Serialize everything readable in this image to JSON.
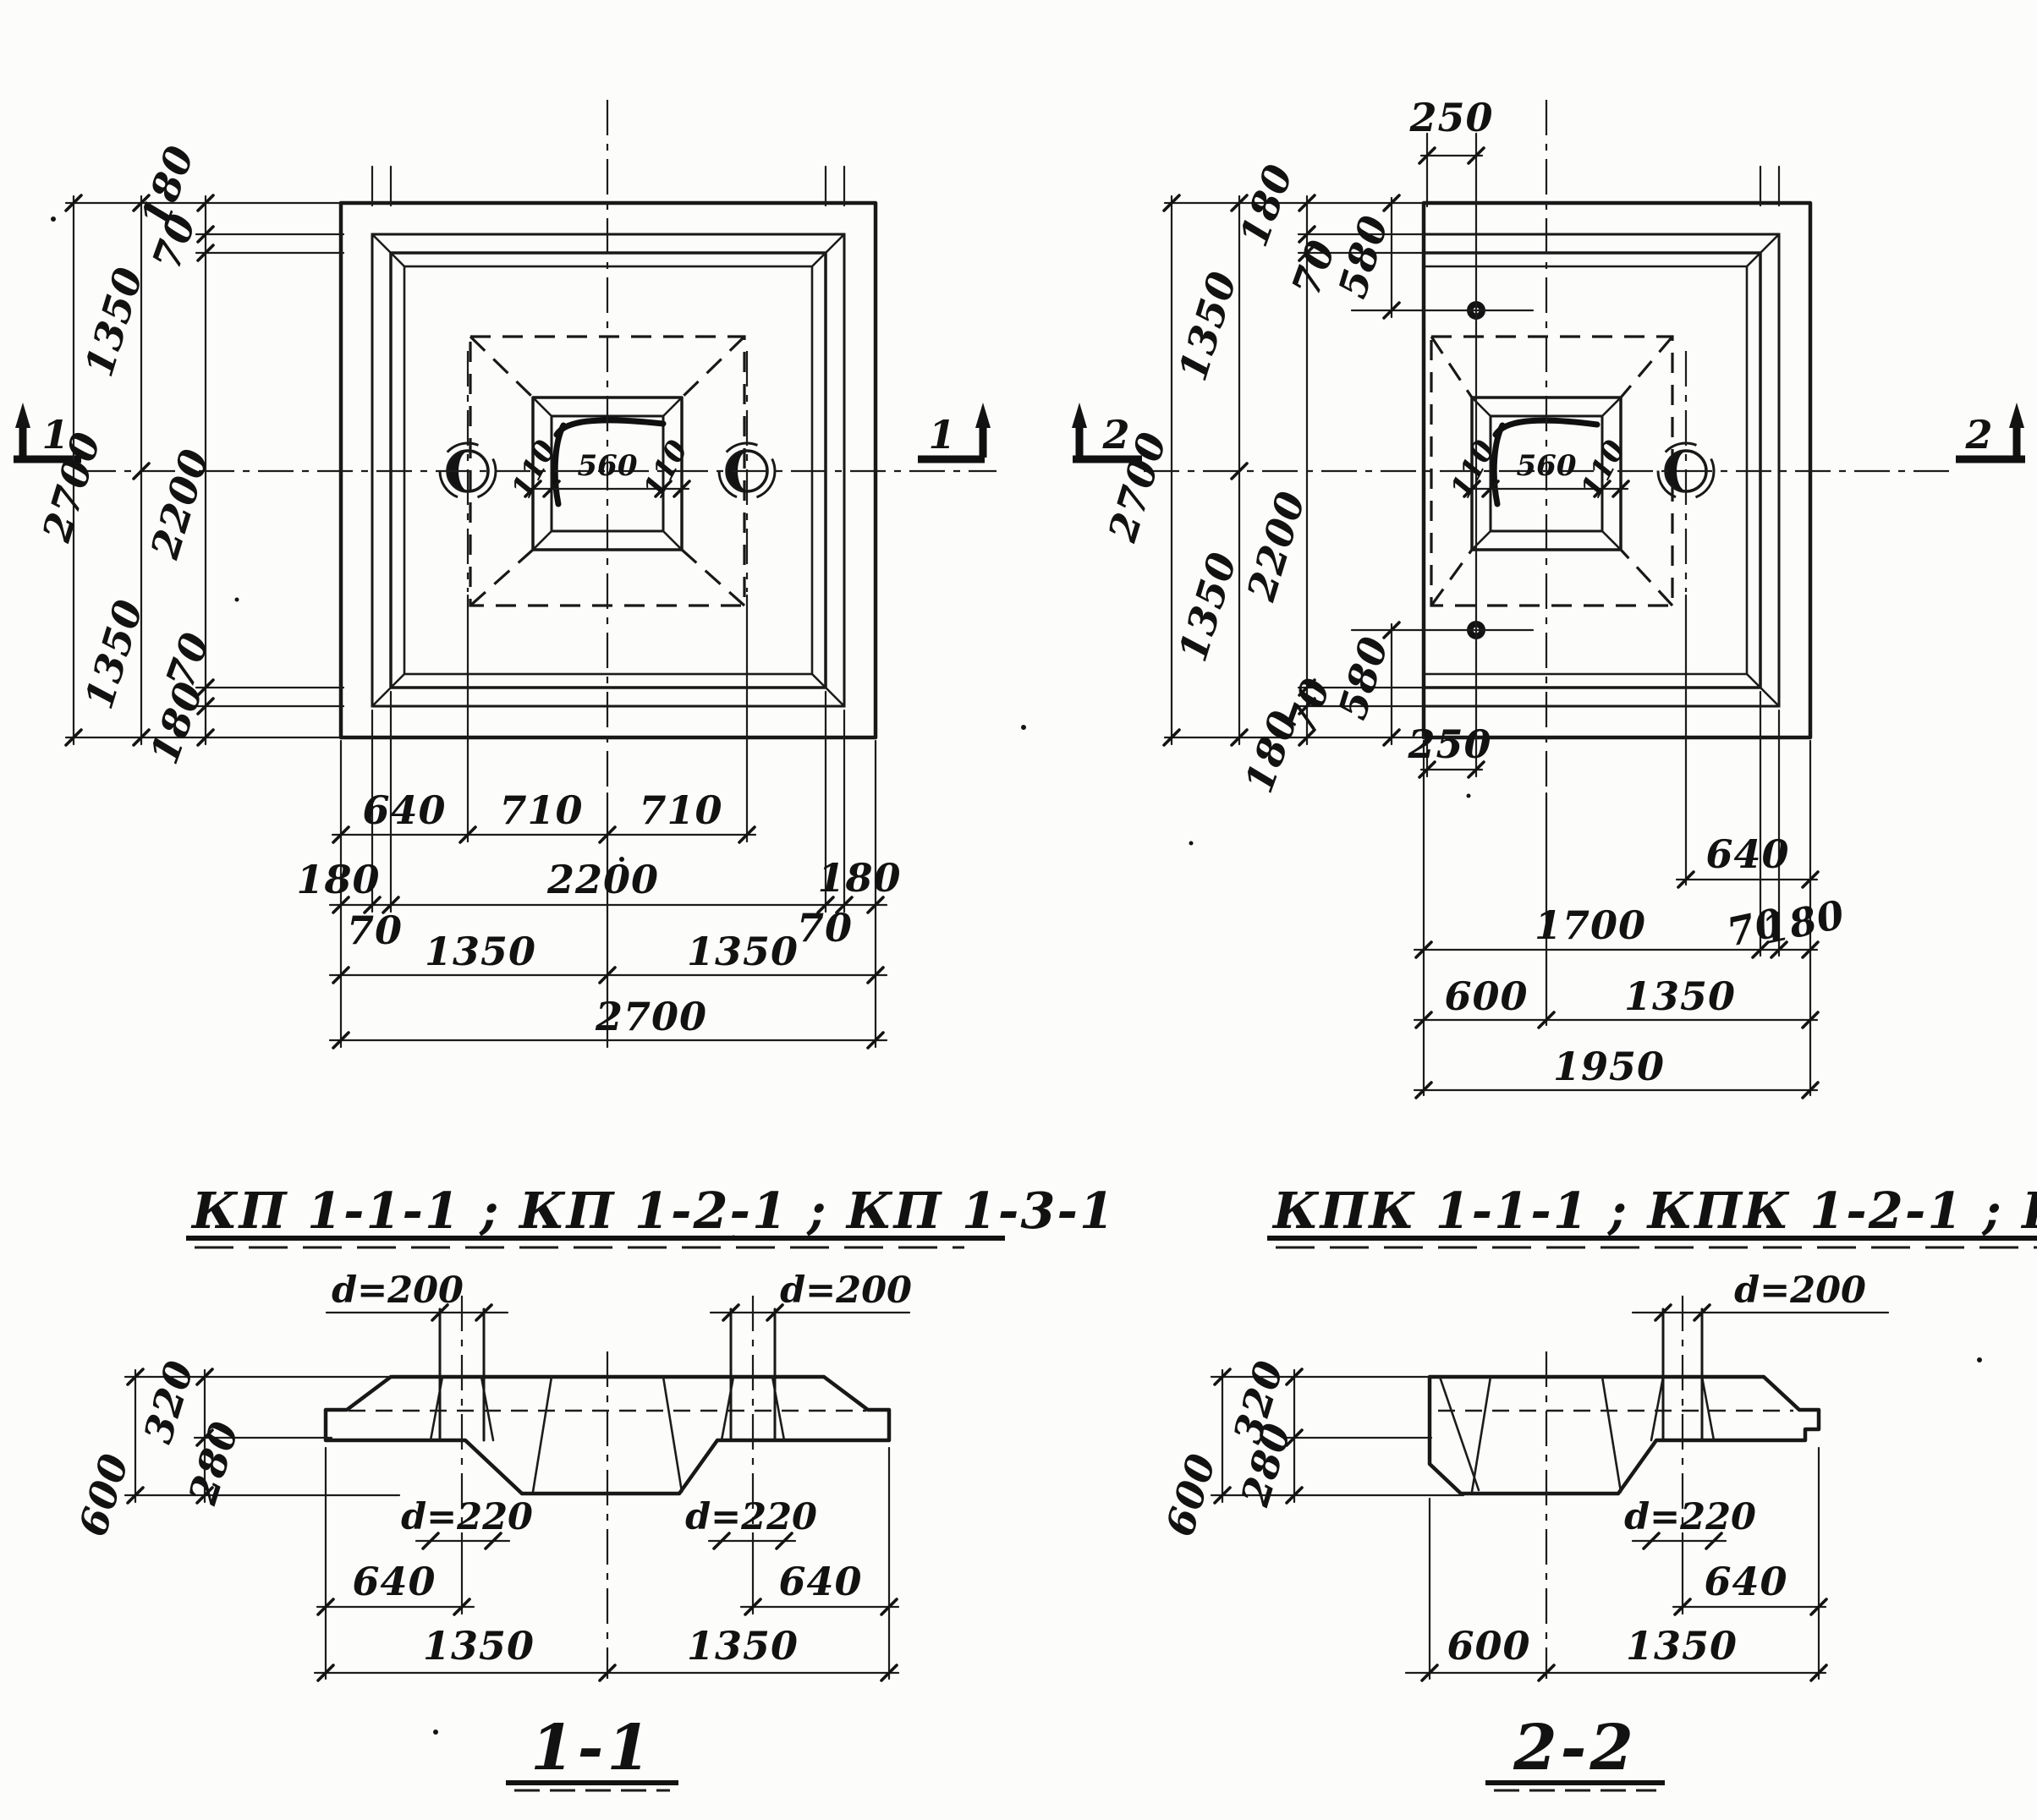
{
  "drawing": {
    "plans": {
      "left": {
        "title": "КП 1-1-1 ; КП 1-2-1 ;  КП 1-3-1",
        "section_mark": "1",
        "dims": {
          "total_v": "2700",
          "half_top": "1350",
          "half_bottom": "1350",
          "edge_top": "180",
          "step_top": "70",
          "inner_v": "2200",
          "step_bottom": "70",
          "edge_bottom": "180",
          "row1_left": "640",
          "row1_mid": "710",
          "row1_right": "710",
          "row2_edge_l": "180",
          "row2_step_l": "70",
          "row2_inner": "2200",
          "row2_step_r": "70",
          "row2_edge_r": "180",
          "row3_left": "1350",
          "row3_right": "1350",
          "row4_total": "2700",
          "pocket_l": "110",
          "pocket_c": "560",
          "pocket_r": "110"
        }
      },
      "right": {
        "title": "КПК 1-1-1 ; КПК 1-2-1 ; КПК 1-3-1",
        "section_mark": "2",
        "dims": {
          "top_offset": "250",
          "bottom_offset": "250",
          "total_v": "2700",
          "half_top": "1350",
          "half_bottom": "1350",
          "edge_top": "180",
          "step_top": "70",
          "inner_v": "2200",
          "step_bottom": "70",
          "edge_bottom": "180",
          "anchor_top": "580",
          "anchor_bottom": "580",
          "row1": "640",
          "row2_inner": "1700",
          "row2_step": "70",
          "row2_edge": "180",
          "row3_left": "600",
          "row3_right": "1350",
          "row4_total": "1950",
          "pocket_l": "110",
          "pocket_c": "560",
          "pocket_r": "110"
        }
      }
    },
    "sections": {
      "s11": {
        "title": "1-1",
        "pin_dia_l": "d=200",
        "pin_dia_r": "d=200",
        "h_total": "600",
        "h_top": "320",
        "h_bottom": "280",
        "hole_dia_l": "d=220",
        "hole_dia_r": "d=220",
        "off_l": "640",
        "off_r": "640",
        "half_l": "1350",
        "half_r": "1350"
      },
      "s22": {
        "title": "2-2",
        "pin_dia": "d=200",
        "h_total": "600",
        "h_top": "320",
        "h_bottom": "280",
        "hole_dia": "d=220",
        "off": "640",
        "left": "600",
        "right": "1350"
      }
    }
  }
}
